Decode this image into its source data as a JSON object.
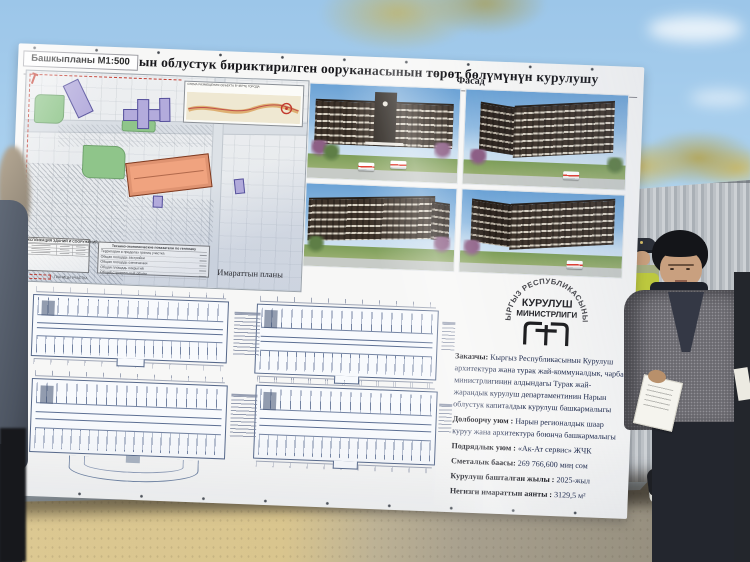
{
  "billboard": {
    "title": "Нарын облустук бириктирилген ооруканасынын төрөт бөлүмүнүн курулушу",
    "masterplan": {
      "label": "Башкыпланы М1:500",
      "inset_title": "СХЕМА РАЗМЕЩЕНИЯ ОБЪЕКТА В ЧЕРТЕ ГОРОДА",
      "legend": {
        "explication_title": "ЭКСПЛИКАЦИЯ ЗДАНИЙ И СООРУЖЕНИЙ",
        "indicators_title": "Технико-экономические показатели по генплану",
        "indicator_rows": [
          "Территория в пределах границ участка",
          "Общая площадь застройки",
          "Общая площадь озеленения",
          "Общая площадь покрытий",
          "Общий строительный объем"
        ],
        "boundary_note": "ГРАНИЦЫ УЧАСТКА"
      }
    },
    "facade": {
      "label": "Фасад"
    },
    "plans": {
      "label": "Имараттын планы"
    },
    "ministry_logo": {
      "arc_text": "КЫРГЫЗ РЕСПУБЛИКАСЫНЫН",
      "line1": "КУРУЛУШ",
      "line2": "МИНИСТРЛИГИ"
    },
    "info": {
      "rows": [
        {
          "label": "Заказчы:",
          "value": "Кыргыз Республикасынын Курулуш архитектура жана турак жай-коммуналдык, чарба министрлигинин алдындагы Турак жай-жарандык курулуш департаментинин Нарын облустук капиталдык курулуш башкармалыгы"
        },
        {
          "label": "Долбоорчу уюм :",
          "value": "Нарын регионалдык шаар куруу жана архитектура боюнча башкармалыгы"
        },
        {
          "label": "Подрядлык уюм :",
          "value": "«Ак-Ат сервис» ЖЧК"
        },
        {
          "label": "Сметалык баасы:",
          "value": "269 766,600 миң сом"
        },
        {
          "label": "Курулуш башталган жылы :",
          "value": "2025-жыл"
        },
        {
          "label": "Негизги имараттын аянты :",
          "value": "3129,5 м²"
        }
      ]
    },
    "colors": {
      "banner_white": "#f7f7f6",
      "site_building_orange": "#f0a37f",
      "site_building_lavender": "#b3abdc",
      "site_greenery": "#8fc58a",
      "boundary_red": "#c23a2e",
      "render_facade_brown": "#3e332a"
    }
  },
  "scene": {
    "colors": {
      "sky_blue": "#aad0ee",
      "foliage_olive": "#a3a05e",
      "fence_gray": "#b3b8bd",
      "ground_tan": "#d9c892",
      "ground_gray": "#9a9382",
      "hi_vis_vest": "#bcc83e"
    }
  }
}
